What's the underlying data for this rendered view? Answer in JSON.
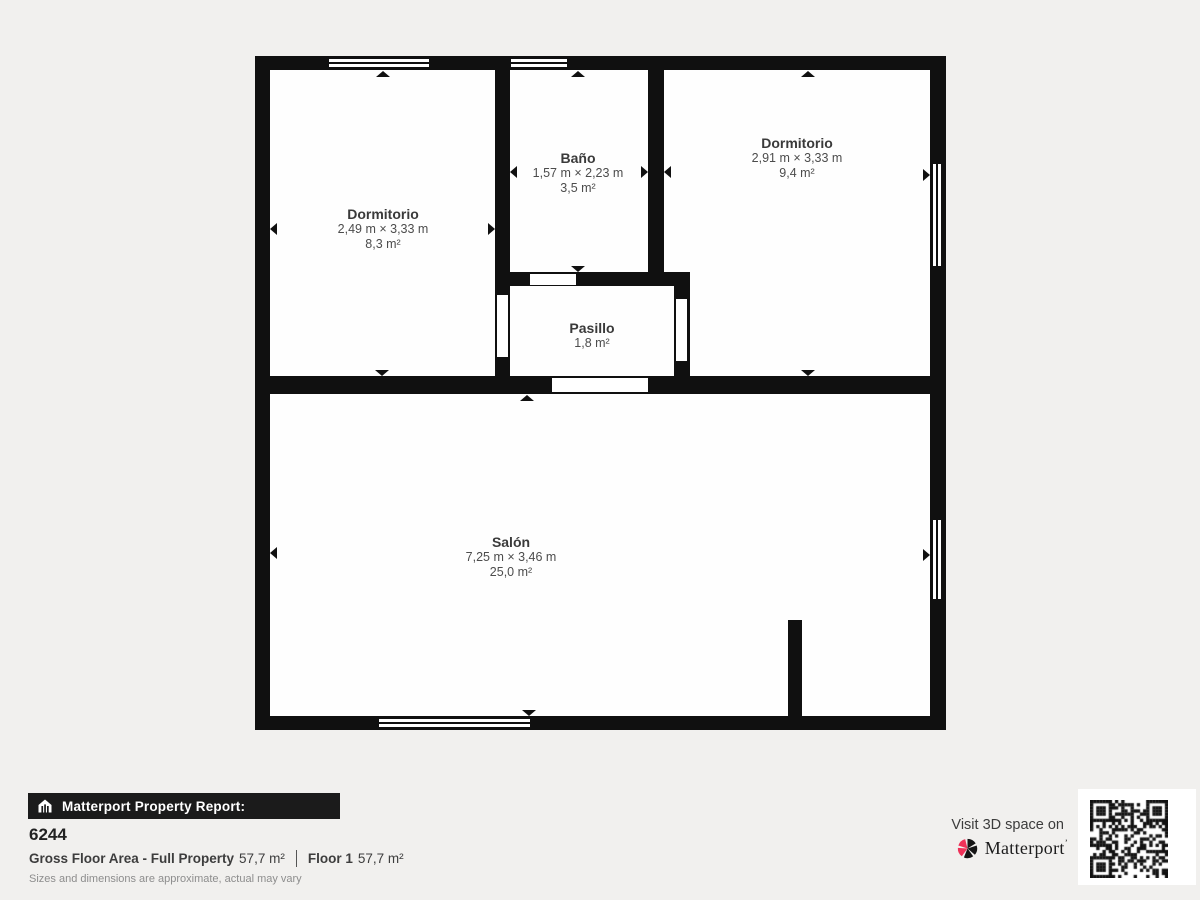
{
  "floorplan": {
    "wall_color": "#101010",
    "room_color": "#ffffff",
    "rooms": [
      {
        "id": "dormitorio-left",
        "name": "Dormitorio",
        "dimensions": "2,49 m × 3,33 m",
        "area": "8,3 m²"
      },
      {
        "id": "bano",
        "name": "Baño",
        "dimensions": "1,57 m × 2,23 m",
        "area": "3,5 m²"
      },
      {
        "id": "dormitorio-right",
        "name": "Dormitorio",
        "dimensions": "2,91 m × 3,33 m",
        "area": "9,4 m²"
      },
      {
        "id": "pasillo",
        "name": "Pasillo",
        "area": "1,8 m²"
      },
      {
        "id": "salon",
        "name": "Salón",
        "dimensions": "7,25 m × 3,46 m",
        "area": "25,0 m²"
      }
    ]
  },
  "footer": {
    "report_bar": "Matterport Property Report:",
    "property_id": "6244",
    "gross_floor_area_label": "Gross Floor Area - Full Property",
    "gross_floor_area_value": "57,7 m²",
    "floor_label": "Floor 1",
    "floor_value": "57,7 m²",
    "disclaimer": "Sizes and dimensions are approximate, actual may vary",
    "visit_text": "Visit 3D space on",
    "brand": "Matterport",
    "brand_tm": "’",
    "brand_pink": "#ee3158"
  }
}
